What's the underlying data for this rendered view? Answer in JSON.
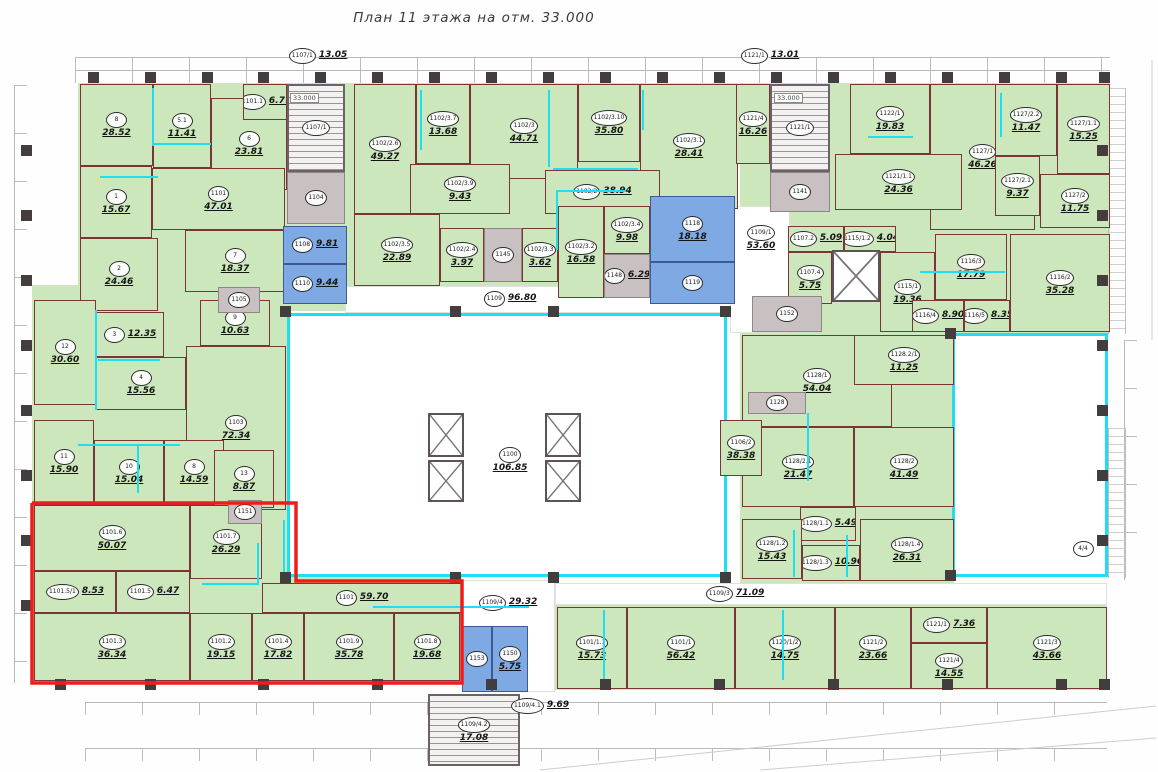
{
  "title": "План 11 этажа на отм. 33.000",
  "palette": {
    "room_green": "#cde7bc",
    "wet_blue": "#7fa9e2",
    "core_gray": "#c9c1c1",
    "wall": "#7a3636",
    "partition_cyan": "#1fdef2",
    "highlight_red": "#f21b1b"
  },
  "central_hall": {
    "id": "1100",
    "area": "106.85"
  },
  "elevation_marks": [
    {
      "text": "33.000",
      "x": 290,
      "y": 93
    },
    {
      "text": "33.000",
      "x": 774,
      "y": 93
    }
  ],
  "bases": [
    [
      78,
      83,
      276,
      228
    ],
    [
      32,
      285,
      256,
      218
    ],
    [
      354,
      83,
      384,
      132
    ],
    [
      440,
      206,
      200,
      80
    ],
    [
      740,
      83,
      370,
      250
    ],
    [
      740,
      333,
      214,
      250
    ],
    [
      555,
      605,
      552,
      85
    ],
    [
      32,
      503,
      430,
      180
    ]
  ],
  "voids": [
    {
      "x": 287,
      "y": 313,
      "w": 440,
      "h": 264,
      "cy": true
    },
    {
      "x": 952,
      "y": 333,
      "w": 156,
      "h": 244,
      "cy": true
    },
    {
      "x": 345,
      "y": 286,
      "w": 390,
      "h": 27,
      "cy": false
    },
    {
      "x": 730,
      "y": 206,
      "w": 60,
      "h": 127,
      "cy": false
    },
    {
      "x": 555,
      "y": 583,
      "w": 552,
      "h": 22,
      "cy": false
    },
    {
      "x": 462,
      "y": 580,
      "w": 93,
      "h": 112,
      "cy": false
    }
  ],
  "rooms": [
    [
      "8",
      "28.52",
      80,
      84,
      73,
      82,
      "g"
    ],
    [
      "5.1",
      "11.41",
      153,
      84,
      58,
      84,
      "g"
    ],
    [
      "6",
      "23.81",
      211,
      98,
      76,
      92,
      "g"
    ],
    [
      "1101.1",
      "6.77",
      243,
      84,
      44,
      36,
      "g"
    ],
    [
      "1101",
      "47.01",
      152,
      168,
      133,
      62,
      "g"
    ],
    [
      "1",
      "15.67",
      80,
      166,
      72,
      72,
      "g"
    ],
    [
      "2",
      "24.46",
      80,
      238,
      78,
      73,
      "g"
    ],
    [
      "7",
      "18.37",
      185,
      230,
      100,
      62,
      "g"
    ],
    [
      "1107/1",
      "",
      287,
      84,
      58,
      88,
      "s"
    ],
    [
      "1104",
      "",
      287,
      172,
      58,
      52,
      "y"
    ],
    [
      "1108",
      "9.81",
      283,
      226,
      64,
      38,
      "b"
    ],
    [
      "1110",
      "9.44",
      283,
      264,
      64,
      40,
      "b"
    ],
    [
      "12",
      "30.60",
      34,
      300,
      62,
      105,
      "g"
    ],
    [
      "3",
      "12.35",
      96,
      312,
      68,
      45,
      "g"
    ],
    [
      "4",
      "15.56",
      96,
      357,
      90,
      53,
      "g"
    ],
    [
      "9",
      "10.63",
      200,
      300,
      70,
      46,
      "g"
    ],
    [
      "1103",
      "72.34",
      186,
      346,
      100,
      164,
      "g"
    ],
    [
      "11",
      "15.90",
      34,
      420,
      60,
      85,
      "g"
    ],
    [
      "10",
      "15.04",
      94,
      440,
      70,
      65,
      "g"
    ],
    [
      "8",
      "14.59",
      164,
      440,
      60,
      65,
      "g"
    ],
    [
      "13",
      "8.87",
      214,
      450,
      60,
      58,
      "g"
    ],
    [
      "1105",
      "",
      218,
      287,
      42,
      26,
      "y"
    ],
    [
      "1102/2.6",
      "49.27",
      354,
      84,
      62,
      130,
      "g"
    ],
    [
      "1102/3.7",
      "13.68",
      416,
      84,
      54,
      80,
      "g"
    ],
    [
      "1102/3",
      "44.71",
      470,
      84,
      108,
      95,
      "g"
    ],
    [
      "1102/3.10",
      "35.80",
      578,
      84,
      62,
      78,
      "g"
    ],
    [
      "1102/3.1",
      "28.41",
      640,
      84,
      98,
      125,
      "g"
    ],
    [
      "1102/3.9",
      "9.43",
      410,
      164,
      100,
      50,
      "g"
    ],
    [
      "1102/2",
      "38.94",
      545,
      170,
      115,
      44,
      "g"
    ],
    [
      "1102/3.5",
      "22.89",
      354,
      214,
      86,
      72,
      "g"
    ],
    [
      "1102/2.4",
      "3.97",
      440,
      228,
      44,
      54,
      "g"
    ],
    [
      "1145",
      "",
      484,
      228,
      38,
      54,
      "y"
    ],
    [
      "1102/3.3",
      "3.62",
      522,
      228,
      36,
      54,
      "g"
    ],
    [
      "1102/3.2",
      "16.58",
      558,
      206,
      46,
      92,
      "g"
    ],
    [
      "1102/3.4",
      "9.98",
      604,
      206,
      46,
      48,
      "g"
    ],
    [
      "1148",
      "6.29",
      604,
      254,
      46,
      44,
      "y"
    ],
    [
      "1118",
      "18.18",
      650,
      196,
      85,
      66,
      "b"
    ],
    [
      "1119",
      "",
      650,
      262,
      85,
      42,
      "b"
    ],
    [
      "1121/4",
      "16.26",
      736,
      84,
      34,
      80,
      "g"
    ],
    [
      "1121/1",
      "",
      770,
      84,
      60,
      88,
      "s"
    ],
    [
      "1141",
      "",
      770,
      172,
      60,
      40,
      "y"
    ],
    [
      "1122/1",
      "19.83",
      850,
      84,
      80,
      70,
      "g"
    ],
    [
      "1127/1",
      "46.26",
      930,
      84,
      105,
      146,
      "g"
    ],
    [
      "1121/1.1",
      "24.36",
      835,
      154,
      127,
      56,
      "g"
    ],
    [
      "1127/2.2",
      "11.47",
      995,
      84,
      62,
      72,
      "g"
    ],
    [
      "1127/1.1",
      "15.25",
      1057,
      84,
      53,
      90,
      "g"
    ],
    [
      "1127/2.1",
      "9.37",
      995,
      156,
      45,
      60,
      "g"
    ],
    [
      "1127/2",
      "11.75",
      1040,
      174,
      70,
      54,
      "g"
    ],
    [
      "1109/1",
      "53.60",
      732,
      214,
      58,
      48,
      "t"
    ],
    [
      "1107.2",
      "5.09",
      788,
      226,
      56,
      26,
      "g"
    ],
    [
      "1115/1.2",
      "4.04",
      844,
      226,
      52,
      26,
      "g"
    ],
    [
      "1107.4",
      "5.75",
      788,
      252,
      44,
      52,
      "g"
    ],
    [
      "1115/1",
      "19.36",
      880,
      252,
      55,
      80,
      "g"
    ],
    [
      "1152",
      "",
      752,
      296,
      70,
      36,
      "y"
    ],
    [
      "1116/3",
      "17.79",
      935,
      234,
      72,
      66,
      "g"
    ],
    [
      "1116/4",
      "8.90",
      912,
      300,
      52,
      32,
      "g"
    ],
    [
      "1116/5",
      "8.35",
      964,
      300,
      46,
      32,
      "g"
    ],
    [
      "1116/2",
      "35.28",
      1010,
      234,
      100,
      98,
      "g"
    ],
    [
      "1128/1",
      "54.04",
      742,
      335,
      150,
      92,
      "g"
    ],
    [
      "1128.2/1",
      "11.25",
      854,
      335,
      100,
      50,
      "g"
    ],
    [
      "1128",
      "",
      748,
      392,
      58,
      22,
      "y"
    ],
    [
      "1128/2.1",
      "21.47",
      742,
      427,
      112,
      80,
      "g"
    ],
    [
      "1128/2",
      "41.49",
      854,
      427,
      100,
      80,
      "g"
    ],
    [
      "1106/2",
      "38.38",
      720,
      420,
      42,
      56,
      "g"
    ],
    [
      "1128/1.1",
      "5.49",
      800,
      507,
      56,
      34,
      "g"
    ],
    [
      "1128/1.2",
      "15.43",
      742,
      519,
      60,
      60,
      "g"
    ],
    [
      "1128/1.3",
      "10.96",
      802,
      545,
      58,
      36,
      "g"
    ],
    [
      "1128/1.4",
      "26.31",
      860,
      519,
      94,
      62,
      "g"
    ],
    [
      "1109",
      "96.80",
      440,
      286,
      140,
      26,
      "t"
    ],
    [
      "1109/3",
      "71.09",
      660,
      583,
      150,
      22,
      "t"
    ],
    [
      "1109/4",
      "29.32",
      462,
      583,
      92,
      40,
      "t"
    ],
    [
      "1100",
      "106.85",
      465,
      432,
      90,
      56,
      "t"
    ],
    [
      "1107/1",
      "13.05",
      278,
      44,
      80,
      24,
      "t"
    ],
    [
      "1121/1",
      "13.01",
      730,
      44,
      80,
      24,
      "t"
    ],
    [
      "4/4",
      "",
      1070,
      538,
      26,
      22,
      "t"
    ],
    [
      "1153",
      "",
      462,
      626,
      30,
      66,
      "b"
    ],
    [
      "1150",
      "5.75",
      492,
      626,
      36,
      66,
      "b"
    ],
    [
      "1109/4.2",
      "17.08",
      428,
      694,
      92,
      72,
      "s"
    ],
    [
      "1109/4.1",
      "9.69",
      500,
      694,
      80,
      24,
      "t"
    ],
    [
      "1101/1.1",
      "15.73",
      557,
      607,
      70,
      82,
      "g"
    ],
    [
      "1101/1",
      "56.42",
      627,
      607,
      108,
      82,
      "g"
    ],
    [
      "1120/1/2",
      "14.75",
      735,
      607,
      100,
      82,
      "g"
    ],
    [
      "1121/2",
      "23.66",
      835,
      607,
      76,
      82,
      "g"
    ],
    [
      "1121/1",
      "7.36",
      911,
      607,
      76,
      36,
      "g"
    ],
    [
      "1121/4",
      "14.55",
      911,
      643,
      76,
      46,
      "g"
    ],
    [
      "1121/3",
      "43.66",
      987,
      607,
      120,
      82,
      "g"
    ],
    [
      "1101.6",
      "50.07",
      34,
      505,
      156,
      66,
      "g"
    ],
    [
      "1101.7",
      "26.29",
      190,
      505,
      72,
      74,
      "g"
    ],
    [
      "1101.5/1",
      "8.53",
      34,
      571,
      82,
      42,
      "g"
    ],
    [
      "1101.5",
      "6.47",
      116,
      571,
      74,
      42,
      "g"
    ],
    [
      "1101.3",
      "36.34",
      34,
      613,
      156,
      68,
      "g"
    ],
    [
      "1101.2",
      "19.15",
      190,
      613,
      62,
      68,
      "g"
    ],
    [
      "1101.4",
      "17.82",
      252,
      613,
      52,
      68,
      "g"
    ],
    [
      "1101.9",
      "35.78",
      304,
      613,
      90,
      68,
      "g"
    ],
    [
      "1101.8",
      "19.68",
      394,
      613,
      66,
      68,
      "g"
    ],
    [
      "1101",
      "59.70",
      262,
      583,
      200,
      30,
      "g"
    ],
    [
      "1151",
      "",
      228,
      500,
      34,
      24,
      "y"
    ]
  ],
  "shafts": [
    [
      428,
      413,
      36,
      44
    ],
    [
      428,
      460,
      36,
      42
    ],
    [
      545,
      413,
      36,
      44
    ],
    [
      545,
      460,
      36,
      42
    ],
    [
      832,
      250,
      48,
      52
    ]
  ],
  "columns": [
    [
      93,
      77
    ],
    [
      150,
      77
    ],
    [
      207,
      77
    ],
    [
      263,
      77
    ],
    [
      320,
      77
    ],
    [
      377,
      77
    ],
    [
      434,
      77
    ],
    [
      491,
      77
    ],
    [
      548,
      77
    ],
    [
      605,
      77
    ],
    [
      662,
      77
    ],
    [
      719,
      77
    ],
    [
      776,
      77
    ],
    [
      833,
      77
    ],
    [
      890,
      77
    ],
    [
      947,
      77
    ],
    [
      1004,
      77
    ],
    [
      1061,
      77
    ],
    [
      1104,
      77
    ],
    [
      60,
      684
    ],
    [
      150,
      684
    ],
    [
      263,
      684
    ],
    [
      377,
      684
    ],
    [
      491,
      684
    ],
    [
      605,
      684
    ],
    [
      719,
      684
    ],
    [
      833,
      684
    ],
    [
      947,
      684
    ],
    [
      1061,
      684
    ],
    [
      1104,
      684
    ],
    [
      26,
      150
    ],
    [
      26,
      215
    ],
    [
      26,
      280
    ],
    [
      26,
      345
    ],
    [
      26,
      410
    ],
    [
      26,
      475
    ],
    [
      26,
      540
    ],
    [
      26,
      605
    ],
    [
      1102,
      150
    ],
    [
      1102,
      215
    ],
    [
      1102,
      280
    ],
    [
      1102,
      345
    ],
    [
      1102,
      410
    ],
    [
      1102,
      475
    ],
    [
      1102,
      540
    ],
    [
      285,
      311
    ],
    [
      455,
      311
    ],
    [
      553,
      311
    ],
    [
      725,
      311
    ],
    [
      285,
      577
    ],
    [
      455,
      577
    ],
    [
      553,
      577
    ],
    [
      725,
      577
    ],
    [
      950,
      333
    ],
    [
      950,
      575
    ]
  ],
  "cyan_lines": [
    [
      152,
      88,
      2,
      58
    ],
    [
      153,
      143,
      58,
      2
    ],
    [
      100,
      176,
      58,
      2
    ],
    [
      420,
      90,
      2,
      60
    ],
    [
      548,
      90,
      2,
      77
    ],
    [
      553,
      168,
      85,
      2
    ],
    [
      642,
      90,
      2,
      40
    ],
    [
      95,
      310,
      2,
      100
    ],
    [
      98,
      359,
      62,
      2
    ],
    [
      78,
      444,
      102,
      2
    ],
    [
      137,
      445,
      2,
      48
    ],
    [
      202,
      583,
      56,
      2
    ],
    [
      257,
      543,
      2,
      42
    ],
    [
      283,
      520,
      2,
      56
    ],
    [
      373,
      606,
      156,
      2
    ],
    [
      603,
      610,
      2,
      70
    ],
    [
      782,
      610,
      2,
      70
    ],
    [
      556,
      190,
      2,
      60
    ],
    [
      556,
      190,
      70,
      2
    ],
    [
      868,
      136,
      45,
      2
    ],
    [
      1000,
      93,
      2,
      44
    ],
    [
      920,
      271,
      85,
      2
    ],
    [
      807,
      413,
      2,
      68
    ],
    [
      793,
      530,
      2,
      47
    ],
    [
      846,
      535,
      2,
      42
    ]
  ],
  "red_outline_points": "32,503 296,503 296,581 462,581 462,683 32,683 32,503",
  "context_lines": [
    "540,770 1156,706",
    "760,770 1156,738",
    "1152,60 1152,340"
  ]
}
